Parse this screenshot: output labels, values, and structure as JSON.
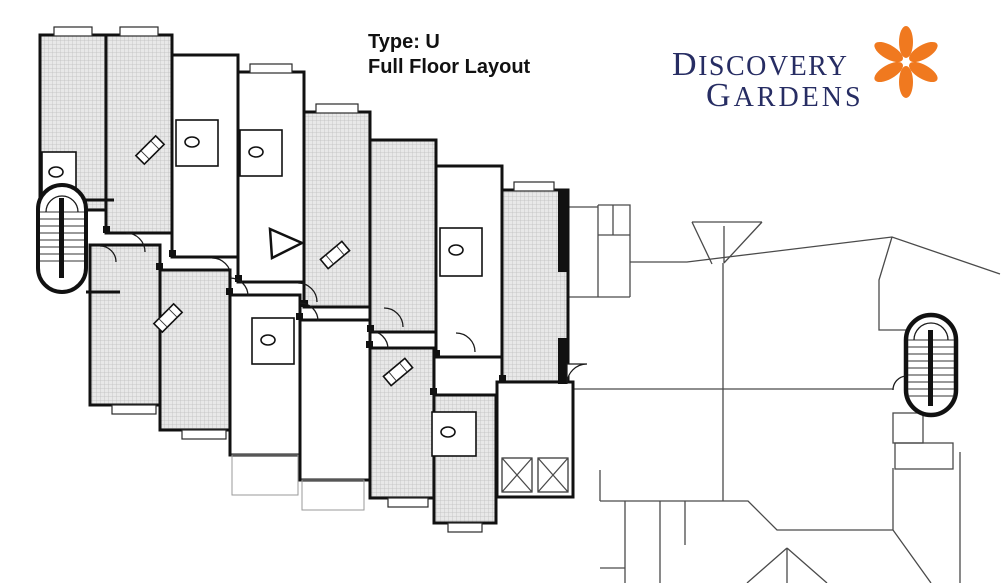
{
  "header": {
    "title_line1": "Type: U",
    "title_line2": "Full Floor Layout"
  },
  "logo": {
    "name": "Discovery Gardens",
    "line1_initial": "D",
    "line1_rest": "ISCOVERY",
    "line2_initial": "G",
    "line2_rest": "ARDENS",
    "text_color": "#272d63",
    "flower_color": "#f0791f",
    "flower_petals": 6
  },
  "plan": {
    "colors": {
      "wall": "#111111",
      "hatch_fill": "#e8e8e8",
      "hatch_grid": "#bcbcbc",
      "outline_wing": "#4a4a4a",
      "background": "#ffffff"
    },
    "features": {
      "left_stairwell": "stairwell-icon",
      "right_stairwell": "stairwell-icon",
      "elevators": "elevator-x-icon",
      "corridor_arrow": "arrow-icon",
      "apartment_units_detailed": 14,
      "elevator_shafts": 2
    }
  }
}
